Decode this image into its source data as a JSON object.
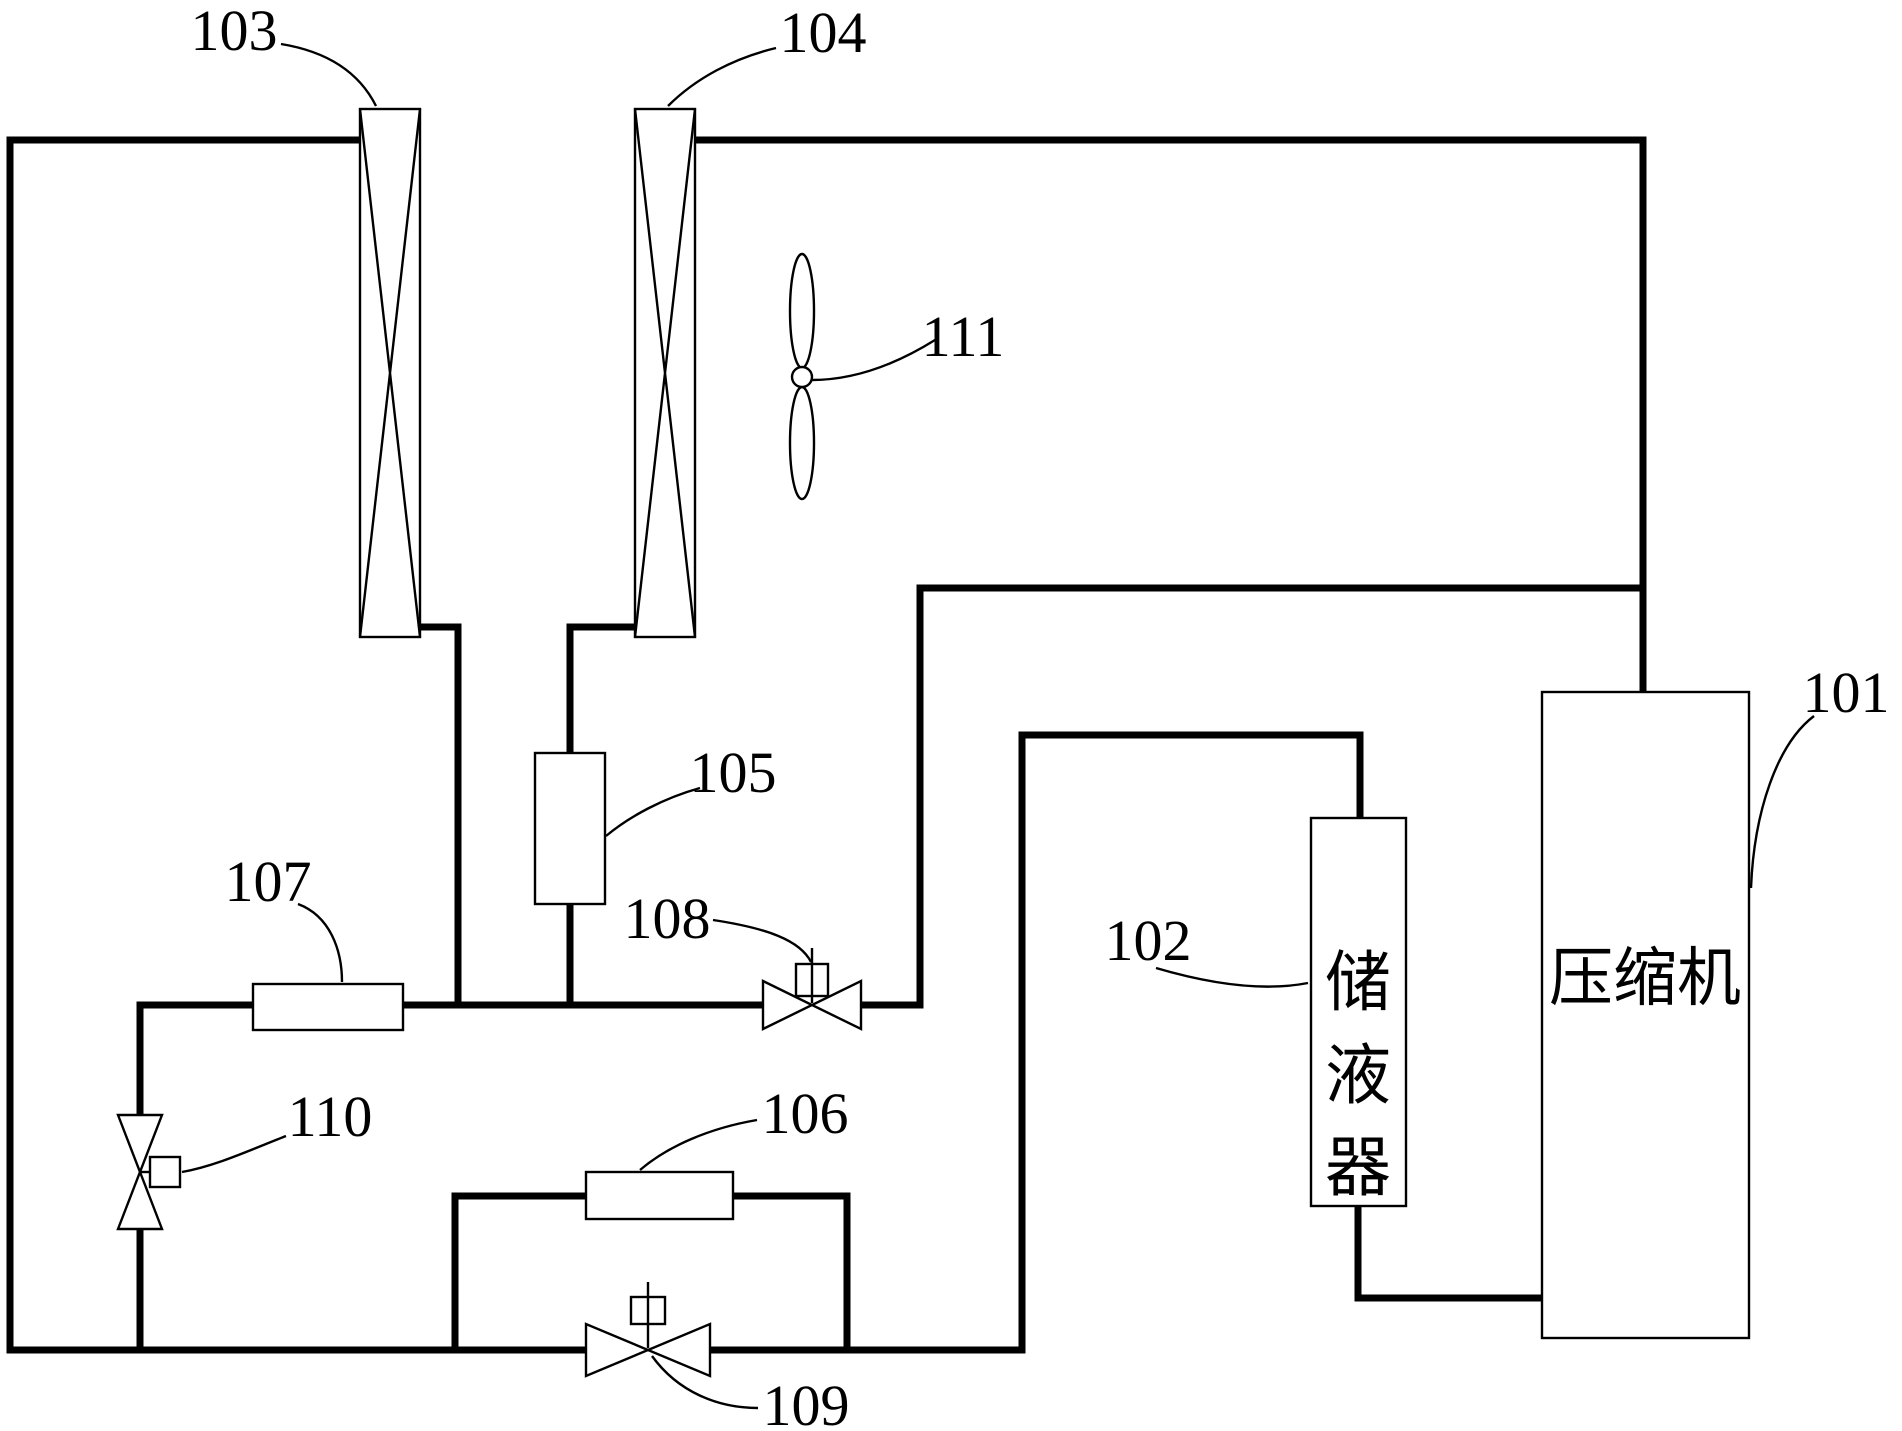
{
  "figure": {
    "kind": "refrigeration-circuit-schematic",
    "colors": {
      "line": "#000000",
      "background": "#ffffff"
    },
    "ref_labels": {
      "compressor": "101",
      "accumulator": "102",
      "left_coil": "103",
      "right_coil": "104",
      "component_105": "105",
      "component_106": "106",
      "component_107": "107",
      "valve_108": "108",
      "valve_109": "109",
      "valve_110": "110",
      "fan": "111"
    },
    "component_text": {
      "compressor": "压缩机",
      "accumulator": "储液器",
      "accumulator_chars": [
        "储",
        "液",
        "器"
      ]
    }
  }
}
